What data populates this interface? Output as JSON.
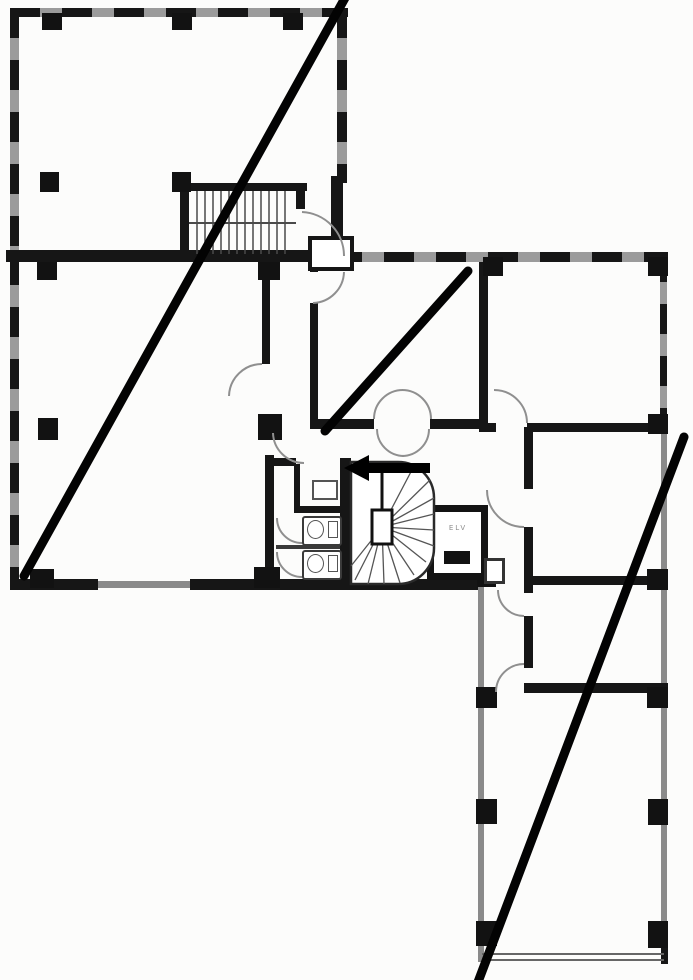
{
  "page": {
    "background": "#fcfcfb"
  },
  "core": {
    "elevator_label": "ELV"
  },
  "colors": {
    "wall": "#161616",
    "window_wall": "#9b9b9b",
    "door_arc": "#8f8f8f",
    "stair_tread": "#4a4a4a",
    "annotation": "#030303",
    "background": "#fcfcfb"
  },
  "annotation": {
    "stroke_width": 9,
    "lines": [
      {
        "x1": 345,
        "y1": -2,
        "x2": 24,
        "y2": 576
      },
      {
        "x1": 468,
        "y1": 271,
        "x2": 325,
        "y2": 431
      },
      {
        "x1": 684,
        "y1": 437,
        "x2": 478,
        "y2": 982
      }
    ]
  }
}
